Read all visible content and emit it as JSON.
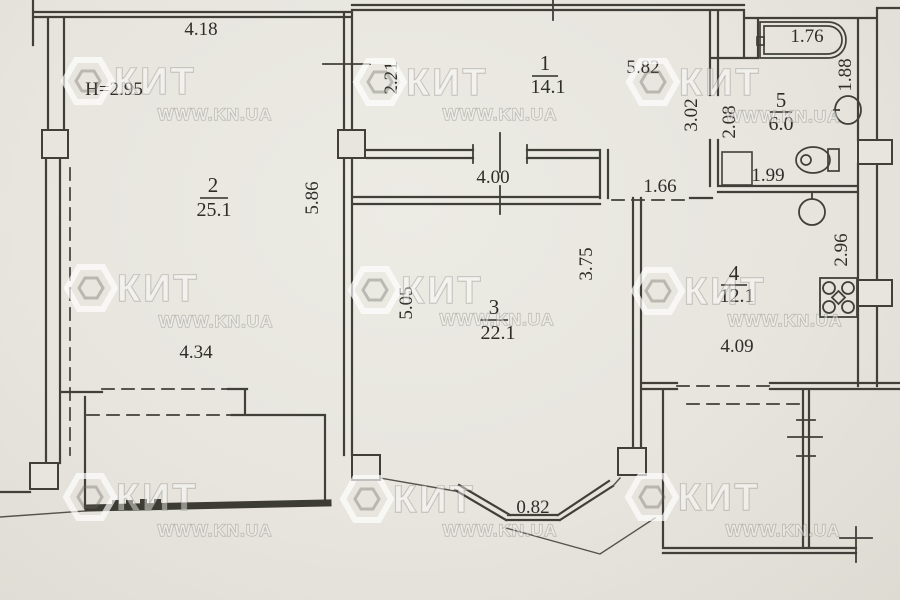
{
  "watermark": {
    "brand": "КИТ",
    "url": "WWW.KN.UA"
  },
  "rooms": {
    "r1": {
      "number": "1",
      "area": "14.1"
    },
    "r2": {
      "number": "2",
      "area": "25.1"
    },
    "r3": {
      "number": "3",
      "area": "22.1"
    },
    "r4": {
      "number": "4",
      "area": "12.1"
    },
    "r5": {
      "number": "5",
      "area": "6.0"
    }
  },
  "dims": {
    "room2_top": "4.18",
    "ceiling_height_note": "H=2.95",
    "room2_bottom": "4.34",
    "room2_right": "5.86",
    "room1_left": "2.21",
    "room1_width": "5.82",
    "corridor_width": "4.00",
    "kitchen_door": "1.66",
    "room3_left": "5.05",
    "room3_right": "3.75",
    "bay_window": "0.82",
    "bathtub_length": "1.76",
    "bath_right": "1.88",
    "hall_left": "3.02",
    "hall_right": "2.08",
    "bath_bottom": "1.99",
    "kitchen_right": "2.96",
    "kitchen_bottom": "4.09"
  },
  "fixtures": {
    "bathtub": "bathtub-icon",
    "washbasin": "washbasin-icon",
    "toilet": "toilet-icon",
    "kitchen_sink": "kitchen-sink-icon",
    "stove": "stove-icon",
    "duct_shaft": "duct-shaft"
  },
  "colors": {
    "paper": "#e7e5de",
    "ink": "#403f3a",
    "watermark_white": "#ffffff"
  }
}
